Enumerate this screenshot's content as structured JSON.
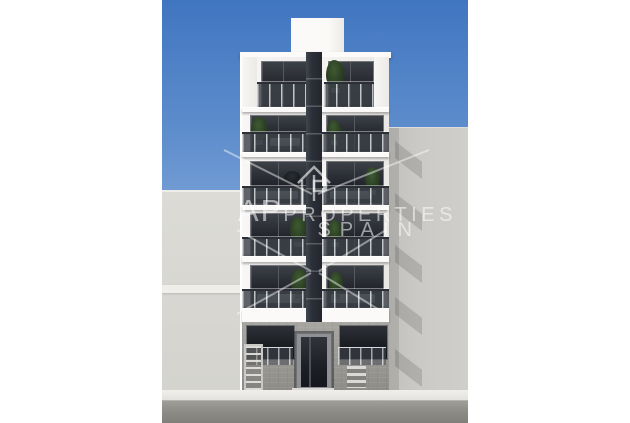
{
  "scene": {
    "subject": "new-build apartment facade render",
    "sky": "clear blue"
  },
  "watermark": {
    "prefix": "AP",
    "rest": "PROPERTIES",
    "country": "SPAIN",
    "logo_icon": "house-logo-icon"
  },
  "colors": {
    "sky_top": "#4076c0",
    "sky_bottom": "#c6d7ee",
    "facade_white": "#f4f3f0",
    "stripe_dark": "#2c3038",
    "rail_glass": "#3e434a",
    "left_wall": "#d8d7d2",
    "right_wall": "#cbcac6",
    "ground_stone": "#9b9994",
    "sidewalk": "#f1efec",
    "street": "#8c8a85",
    "plant_green": "#2c4023"
  },
  "building": {
    "floor_count": 6,
    "floors": [
      {
        "name": "floor-6-attic",
        "recessed": true,
        "windows": [
          {
            "x": 99,
            "y": 61,
            "w": 44,
            "h": 44
          },
          {
            "x": 166,
            "y": 61,
            "w": 44,
            "h": 44
          }
        ],
        "rails": [
          {
            "x": 95,
            "y": 82,
            "w": 52,
            "h": 25
          },
          {
            "x": 162,
            "y": 82,
            "w": 50,
            "h": 25
          }
        ],
        "pillars": [
          {
            "x": 80,
            "y": 57,
            "w": 15,
            "h": 50
          },
          {
            "x": 212,
            "y": 57,
            "w": 15,
            "h": 50
          }
        ],
        "plants": [
          {
            "x": 164,
            "y": 60,
            "w": 18,
            "h": 28
          }
        ],
        "furniture": [],
        "slab": {
          "y": 107,
          "h": 5
        }
      },
      {
        "name": "floor-5",
        "windows": [
          {
            "x": 88,
            "y": 115,
            "w": 56,
            "h": 35
          },
          {
            "x": 164,
            "y": 115,
            "w": 56,
            "h": 35
          }
        ],
        "rails": [
          {
            "x": 80,
            "y": 132,
            "w": 67,
            "h": 20
          },
          {
            "x": 160,
            "y": 132,
            "w": 67,
            "h": 20
          }
        ],
        "pillars": [],
        "plants": [
          {
            "x": 89,
            "y": 117,
            "w": 16,
            "h": 23
          },
          {
            "x": 165,
            "y": 120,
            "w": 14,
            "h": 20
          }
        ],
        "furniture": [
          {
            "x": 108,
            "y": 138,
            "w": 30,
            "h": 8,
            "dark": false
          }
        ],
        "slab": {
          "y": 152,
          "h": 5
        }
      },
      {
        "name": "floor-4",
        "windows": [
          {
            "x": 88,
            "y": 161,
            "w": 56,
            "h": 41
          },
          {
            "x": 164,
            "y": 161,
            "w": 56,
            "h": 41
          }
        ],
        "rails": [
          {
            "x": 80,
            "y": 186,
            "w": 67,
            "h": 19
          },
          {
            "x": 160,
            "y": 186,
            "w": 67,
            "h": 19
          }
        ],
        "pillars": [],
        "plants": [
          {
            "x": 203,
            "y": 167,
            "w": 15,
            "h": 23
          }
        ],
        "furniture": [
          {
            "x": 122,
            "y": 171,
            "w": 16,
            "h": 13,
            "dark": true
          },
          {
            "x": 94,
            "y": 191,
            "w": 42,
            "h": 8,
            "dark": false
          },
          {
            "x": 168,
            "y": 191,
            "w": 42,
            "h": 8,
            "dark": false
          }
        ],
        "slab": {
          "y": 205,
          "h": 5
        }
      },
      {
        "name": "floor-3",
        "windows": [
          {
            "x": 88,
            "y": 213,
            "w": 56,
            "h": 41
          },
          {
            "x": 164,
            "y": 213,
            "w": 56,
            "h": 41
          }
        ],
        "rails": [
          {
            "x": 80,
            "y": 237,
            "w": 67,
            "h": 19
          },
          {
            "x": 160,
            "y": 237,
            "w": 67,
            "h": 19
          }
        ],
        "pillars": [],
        "plants": [
          {
            "x": 128,
            "y": 217,
            "w": 17,
            "h": 25
          },
          {
            "x": 166,
            "y": 220,
            "w": 14,
            "h": 22
          }
        ],
        "furniture": [],
        "slab": {
          "y": 256,
          "h": 6
        }
      },
      {
        "name": "floor-2",
        "windows": [
          {
            "x": 88,
            "y": 265,
            "w": 56,
            "h": 41
          },
          {
            "x": 164,
            "y": 265,
            "w": 56,
            "h": 41
          }
        ],
        "rails": [
          {
            "x": 80,
            "y": 289,
            "w": 67,
            "h": 19
          },
          {
            "x": 160,
            "y": 289,
            "w": 67,
            "h": 19
          }
        ],
        "pillars": [],
        "plants": [
          {
            "x": 129,
            "y": 269,
            "w": 17,
            "h": 25
          },
          {
            "x": 167,
            "y": 272,
            "w": 14,
            "h": 22
          }
        ],
        "furniture": [
          {
            "x": 95,
            "y": 294,
            "w": 44,
            "h": 9,
            "dark": false
          },
          {
            "x": 169,
            "y": 294,
            "w": 44,
            "h": 9,
            "dark": false
          }
        ],
        "slab": {
          "y": 308,
          "h": 14
        }
      },
      {
        "name": "ground-floor"
      }
    ],
    "ground": {
      "windows": [
        {
          "x": 4,
          "w": 47
        },
        {
          "x": 97,
          "w": 47
        }
      ],
      "rails": [
        {
          "x": 3,
          "w": 48
        },
        {
          "x": 96,
          "w": 48
        }
      ],
      "has_ladder": true,
      "has_steps": true,
      "plant": {
        "x": 129,
        "y": 337,
        "w": 11,
        "h": 19
      }
    },
    "right_wall_shadow_teeth_y": [
      140,
      192,
      244,
      296,
      348
    ]
  }
}
